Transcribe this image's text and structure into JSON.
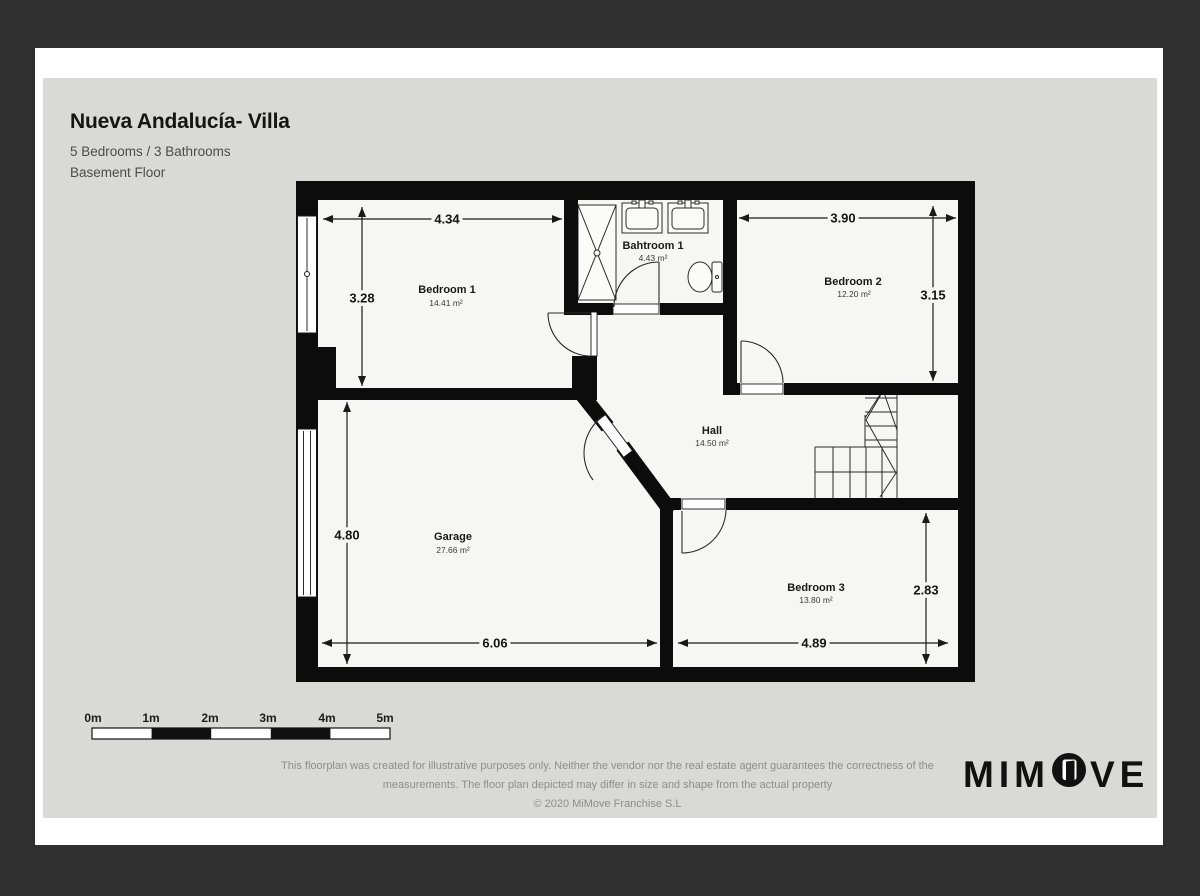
{
  "header": {
    "title": "Nueva Andalucía- Villa",
    "subtitle": "5 Bedrooms / 3 Bathrooms",
    "floor_label": "Basement Floor"
  },
  "plan": {
    "rooms": {
      "bedroom1": {
        "name": "Bedroom 1",
        "area": "14.41 m²",
        "width": "4.34",
        "height": "3.28"
      },
      "bathroom1": {
        "name": "Bahtroom 1",
        "area": "4.43 m²"
      },
      "bedroom2": {
        "name": "Bedroom 2",
        "area": "12.20 m²",
        "width": "3.90",
        "height": "3.15"
      },
      "hall": {
        "name": "Hall",
        "area": "14.50 m²"
      },
      "garage": {
        "name": "Garage",
        "area": "27.66 m²",
        "width": "6.06",
        "height": "4.80"
      },
      "bedroom3": {
        "name": "Bedroom 3",
        "area": "13.80 m²",
        "width": "4.89",
        "height": "2.83"
      }
    }
  },
  "scale_bar": {
    "labels": [
      "0m",
      "1m",
      "2m",
      "3m",
      "4m",
      "5m"
    ]
  },
  "footer": {
    "disclaimer_line1": "This floorplan was created for illustrative purposes only. Neither the vendor nor the real estate agent guarantees the correctness of the",
    "disclaimer_line2": "measurements. The floor plan depicted may differ in size and shape from the actual property",
    "copyright": "© 2020 MiMove Franchise S.L"
  },
  "logo": {
    "left": "MIM",
    "right": "VE"
  },
  "colors": {
    "frame": "#2f2f2f",
    "paper": "#ffffff",
    "page": "#d9d9d8",
    "wall": "#0c0c0c",
    "floor": "#f6f6f5",
    "muted_text": "#8d8d8d"
  }
}
